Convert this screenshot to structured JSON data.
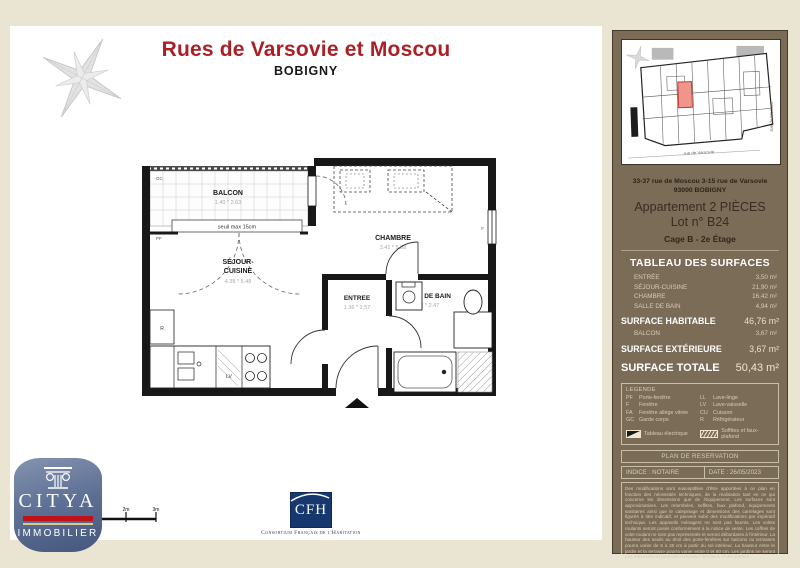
{
  "page": {
    "title": "Rues de Varsovie et Moscou",
    "subtitle": "BOBIGNY"
  },
  "plan": {
    "rooms": {
      "balcon": {
        "name": "BALCON",
        "dims": "1.40 * 2.63",
        "seuil": "seuil max 15cm"
      },
      "chambre": {
        "name": "CHAMBRE",
        "dims": "3.41 * 5.88"
      },
      "sejour": {
        "line1": "SÉJOUR-",
        "line2": "CUISINE",
        "dims": "4.38 * 5.48"
      },
      "entree": {
        "name": "ENTREE",
        "dims": "1.36 * 2.57"
      },
      "sdb": {
        "name": "SALLE DE BAIN",
        "dims": "2.22 * 2.47"
      }
    },
    "labels": {
      "gc": "GC",
      "pf": "PF",
      "f": "F",
      "lv": "LV",
      "r": "R"
    },
    "scale_ticks": [
      "2m",
      "3m"
    ]
  },
  "sidebar": {
    "site_plan": {
      "street_right": "rue de Moscou",
      "street_bottom": "rue de Varsovie"
    },
    "address_line1": "33-37 rue de Moscou 3-15 rue de Varsovie",
    "address_line2": "93000 BOBIGNY",
    "apartment_line1": "Appartement 2 PIÈCES",
    "apartment_line2": "Lot n° B24",
    "cage": "Cage B - 2e Étage",
    "surfaces": {
      "heading": "TABLEAU DES SURFACES",
      "rows": [
        {
          "label": "ENTRÉE",
          "value": "3,50 m²"
        },
        {
          "label": "SÉJOUR-CUISINE",
          "value": "21,90 m²"
        },
        {
          "label": "CHAMBRE",
          "value": "16,42 m²"
        },
        {
          "label": "SALLE DE BAIN",
          "value": "4,94 m²"
        }
      ],
      "habitable": {
        "label": "SURFACE HABITABLE",
        "value": "46,76 m²"
      },
      "balcon_row": {
        "label": "BALCON",
        "value": "3,67 m²"
      },
      "exterieure": {
        "label": "SURFACE EXTÉRIEURE",
        "value": "3,67 m²"
      },
      "totale": {
        "label": "SURFACE TOTALE",
        "value": "50,43 m²"
      }
    },
    "legend": {
      "title": "LEGENDE",
      "items_left": [
        {
          "abbr": "PF",
          "term": "Porte-fenêtre"
        },
        {
          "abbr": "F",
          "term": "Fenêtre"
        },
        {
          "abbr": "FA",
          "term": "Fenêtre allège vitrée"
        },
        {
          "abbr": "GC",
          "term": "Garde corps"
        }
      ],
      "items_right": [
        {
          "abbr": "LL",
          "term": "Lave-linge"
        },
        {
          "abbr": "LV",
          "term": "Lave-vaisselle"
        },
        {
          "abbr": "CU",
          "term": "Cuisson"
        },
        {
          "abbr": "R",
          "term": "Réfrigérateur"
        }
      ],
      "electric": "Tableau électrique",
      "soffits": "Soffites et faux-plafond"
    },
    "reservation": {
      "title": "PLAN DE RESERVATION",
      "indice": "INDICE :  NOTAIRE",
      "date": "DATE : 26/05/2023"
    },
    "disclaimer": "Des modifications sont susceptibles d'être apportées à ce plan en fonction des nécessités techniques, de la réalisation tant en ce qui concerne les dimensions que de l'équipement. Les surfaces sont approximatives. Les retombées, soffites, faux plafond, équipements sanitaires ainsi que le calepinage et dimensions des carrelages sont figurés à titre indicatif, et peuvent subir des modifications par impératif technique. Les appareils ménagers ne sont pas fournis. Les volets roulants seront posés conformément à la notice de vente. Les coffres de volet roulant ne sont pas représentés et seront débordants à l'intérieur. La hauteur des seuils au droit des porte-fenêtres sur balcons ou terrasses pourra varier de 5 à 35 cm à partir du sol intérieur. La hauteur entre le jardin et la terrasse pourra varier entre 0 et 60 cm. Les jardins ne seront pas rehaussés et pourront comporter des talus et des pentes."
  },
  "footer": {
    "citya": {
      "name": "CITYA",
      "sub": "IMMOBILIER"
    },
    "cfh": {
      "name": "CFH",
      "caption": "Consortium Français de l'Habitation"
    }
  },
  "colors": {
    "title_red": "#ab2026",
    "sidebar_brown": "#7b6c57",
    "background_beige": "#eae4d2",
    "highlight_unit": "#f0958c",
    "citya_blue": "#5e7095",
    "citya_red": "#bf1218",
    "cfh_blue": "#16386f"
  }
}
